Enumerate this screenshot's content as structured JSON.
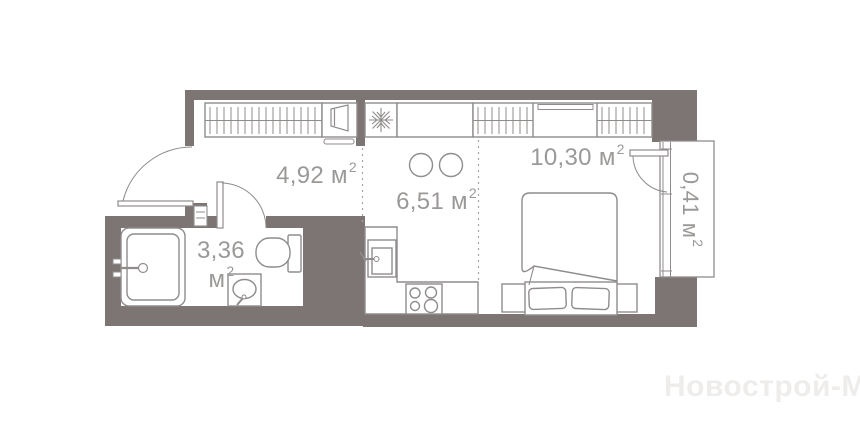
{
  "plan": {
    "type": "apartment-floor-plan",
    "watermark": "Новострой-М",
    "colors": {
      "wall": "#7c7573",
      "furniture_outline": "#8f8c8b",
      "label_text": "#9b9997",
      "watermark_text": "#efedeb",
      "zone_divider": "#a8a5a3",
      "background": "#ffffff"
    },
    "rooms": [
      {
        "name": "hallway",
        "area": "4,92",
        "unit": "м",
        "sup": "2"
      },
      {
        "name": "kitchen",
        "area": "6,51",
        "unit": "м",
        "sup": "2"
      },
      {
        "name": "living",
        "area": "10,30",
        "unit": "м",
        "sup": "2"
      },
      {
        "name": "bathroom",
        "area": "3,36",
        "unit": "м",
        "sup": "2"
      },
      {
        "name": "balcony",
        "area": "0,41",
        "unit": "м",
        "sup": "2"
      }
    ],
    "icons": [
      "hanger-rail-icon",
      "snowflake-fridge-icon",
      "shoe-cabinet-icon",
      "stove-burners-icon",
      "kitchen-sink-icon",
      "bathtub-icon",
      "toilet-icon",
      "washbasin-icon",
      "bed-icon",
      "pillow-icon",
      "door-swing-arc-icon",
      "balcony-glazing-icon",
      "stool-icon"
    ]
  },
  "labels": {
    "hallway": {
      "value": "4,92",
      "unit": "м",
      "sup": "2"
    },
    "kitchen": {
      "value": "6,51",
      "unit": "м",
      "sup": "2"
    },
    "living": {
      "value": "10,30",
      "unit": "м",
      "sup": "2"
    },
    "bathroom": {
      "value": "3,36",
      "unit": "м",
      "sup": "2"
    },
    "balcony": {
      "value": "0,41",
      "unit": "м",
      "sup": "2"
    }
  },
  "watermark": {
    "text": "Новострой-М"
  }
}
